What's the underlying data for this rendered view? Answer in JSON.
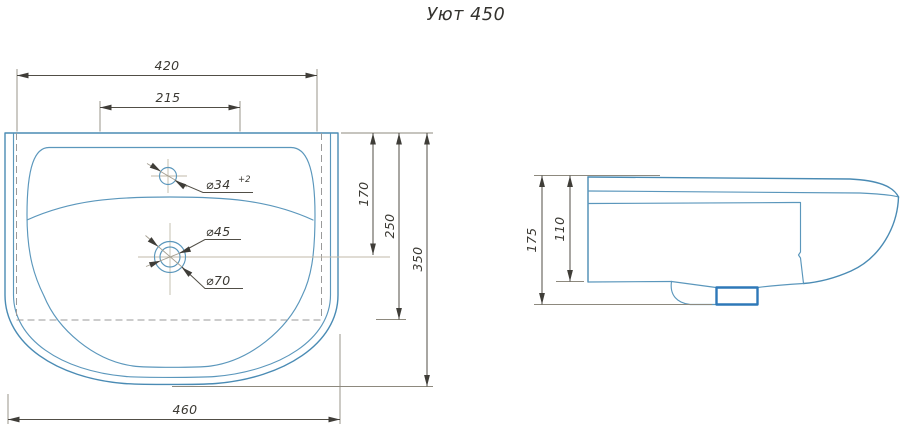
{
  "title": "Уют 450",
  "colors": {
    "product_outline": "#4a8bb4",
    "drain_trap_accent": "#2e78b8",
    "dimension_lines": "#514e46",
    "background": "#ffffff"
  },
  "views": {
    "top": {
      "name": "top view (plan) of washbasin",
      "dims": {
        "w420": "420",
        "w215": "215",
        "d170": "170",
        "d250": "250",
        "d350": "350",
        "w460": "460"
      },
      "labels": {
        "faucet_hole": "⌀34",
        "faucet_hole_tolerance": "+2",
        "drain_inner": "⌀45",
        "drain_outer": "⌀70"
      }
    },
    "side": {
      "name": "side view (profile) of washbasin",
      "dims": {
        "h175": "175",
        "h110": "110"
      }
    }
  }
}
